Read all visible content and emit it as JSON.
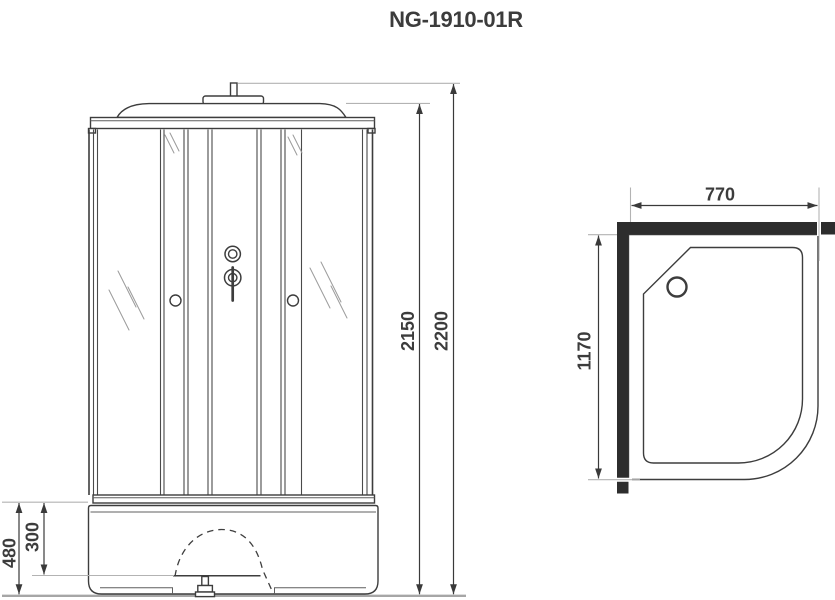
{
  "title": "NG-1910-01R",
  "colors": {
    "line": "#3d3d3d",
    "dim": "#3a3a3a",
    "light": "#b3b3b3",
    "floor": "#a6a6a6",
    "wall": "#2d2d2d",
    "text": "#3c3c3c",
    "bg": "#ffffff"
  },
  "front_view": {
    "dimensions": {
      "overall_height": "2200",
      "cabin_height": "2150",
      "tray_height": "480",
      "tray_inner_depth": "300"
    }
  },
  "top_view": {
    "dimensions": {
      "width": "770",
      "depth": "1170"
    }
  }
}
